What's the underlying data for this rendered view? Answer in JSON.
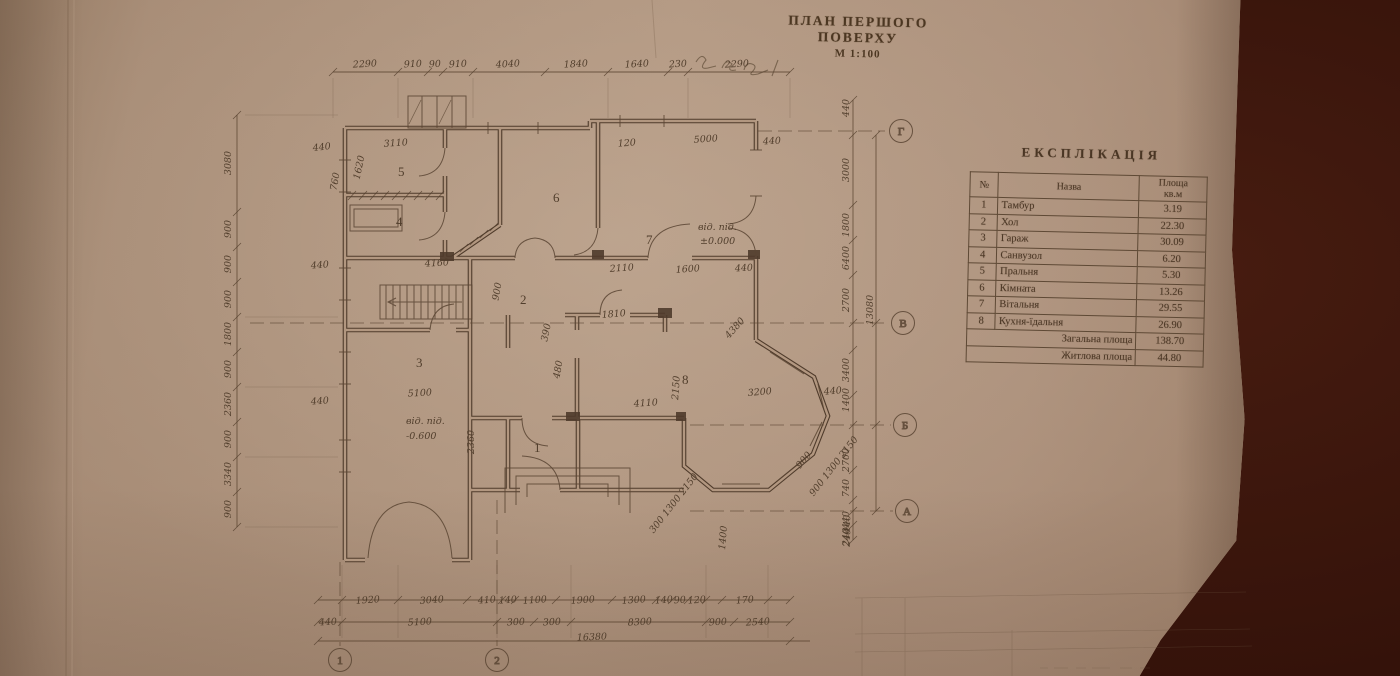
{
  "title": {
    "main": "ПЛАН ПЕРШОГО ПОВЕРХУ",
    "scale": "М 1:100"
  },
  "explication": {
    "heading": "ЕКСПЛІКАЦІЯ",
    "col_num": "№",
    "col_name": "Назва",
    "col_area_line1": "Площа",
    "col_area_line2": "кв.м",
    "rows": [
      {
        "num": "1",
        "name": "Тамбур",
        "area": "3.19"
      },
      {
        "num": "2",
        "name": "Хол",
        "area": "22.30"
      },
      {
        "num": "3",
        "name": "Гараж",
        "area": "30.09"
      },
      {
        "num": "4",
        "name": "Санвузол",
        "area": "6.20"
      },
      {
        "num": "5",
        "name": "Пральня",
        "area": "5.30"
      },
      {
        "num": "6",
        "name": "Кімната",
        "area": "13.26"
      },
      {
        "num": "7",
        "name": "Вітальня",
        "area": "29.55"
      },
      {
        "num": "8",
        "name": "Кухня-їдальня",
        "area": "26.90"
      }
    ],
    "total_label": "Загальна площа",
    "total_value": "138.70",
    "living_label": "Житлова площа",
    "living_value": "44.80"
  },
  "plan": {
    "rooms": [
      "1",
      "2",
      "3",
      "4",
      "5",
      "6",
      "7",
      "8"
    ],
    "levels": {
      "label_main": "від. під.",
      "value_main": "±0.000",
      "label_garage": "від. під.",
      "value_garage": "-0.600"
    },
    "axes": {
      "right": [
        "Г",
        "В",
        "Б",
        "А"
      ],
      "bottom": [
        "1",
        "2"
      ]
    },
    "dims": {
      "top": [
        "2290",
        "910",
        "90",
        "910",
        "4040",
        "1840",
        "1640",
        "230",
        "2290"
      ],
      "left": [
        "3080",
        "900",
        "900",
        "900",
        "1800",
        "900",
        "2360",
        "900",
        "3340",
        "900"
      ],
      "right_inner": [
        "440",
        "3000",
        "1800",
        "6400",
        "2700",
        "3400",
        "1400",
        "2700",
        "740",
        "440",
        "240"
      ],
      "right_total": "13080",
      "bottom_row1": [
        "1920",
        "3040",
        "410",
        "140",
        "1100",
        "1900",
        "1300",
        "140",
        "90",
        "120",
        "170"
      ],
      "bottom_row2": [
        "440",
        "5100",
        "300",
        "300",
        "8300",
        "900",
        "2540"
      ],
      "bottom_total": "16380",
      "interior": [
        "3110",
        "1620",
        "440",
        "4160",
        "2110",
        "1600",
        "440",
        "5000",
        "120",
        "440",
        "5100",
        "4110",
        "3200",
        "440",
        "2150",
        "390",
        "480",
        "1810",
        "4380",
        "1400",
        "900",
        "300 1300 2150",
        "900 1300 2150",
        "440",
        "240",
        "760",
        "2360",
        "440",
        "440",
        "900"
      ]
    }
  }
}
